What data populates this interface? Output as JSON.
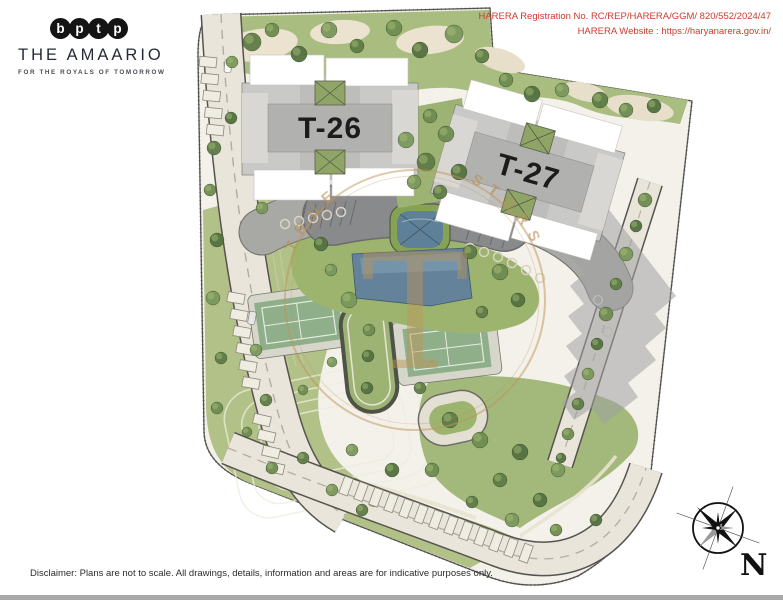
{
  "branding": {
    "logo_letters": [
      "b",
      "p",
      "t",
      "p"
    ],
    "title": "THE AMAARIO",
    "tagline": "FOR THE ROYALS OF TOMORROW"
  },
  "regulatory": {
    "registration": "HARERA Registration No. RC/REP/HARERA/GGM/ 820/552/2024/47",
    "website": "HARERA Website : https://haryanarera.gov.in/",
    "text_color": "#cf3a2e"
  },
  "site_plan": {
    "towers": [
      {
        "label": "T-26"
      },
      {
        "label": "T-27"
      }
    ],
    "watermark": {
      "arc_left": "TRUE",
      "arc_right": "STORS",
      "monogram": "T",
      "color": "#c09355"
    },
    "compass": {
      "label": "N"
    },
    "palette": {
      "lawn": "#9db46f",
      "road": "#e9e5da",
      "deck": "#a8a8a4",
      "entry_court": "#898a8c",
      "water": "#64839a",
      "tennis_court": "#8fae8a",
      "tower_roof": "#c9c9c7",
      "shadow": "#a0a0a2"
    }
  },
  "footer": {
    "disclaimer": "Disclaimer: Plans are not to scale. All drawings, details, information and areas are for indicative purposes only."
  }
}
